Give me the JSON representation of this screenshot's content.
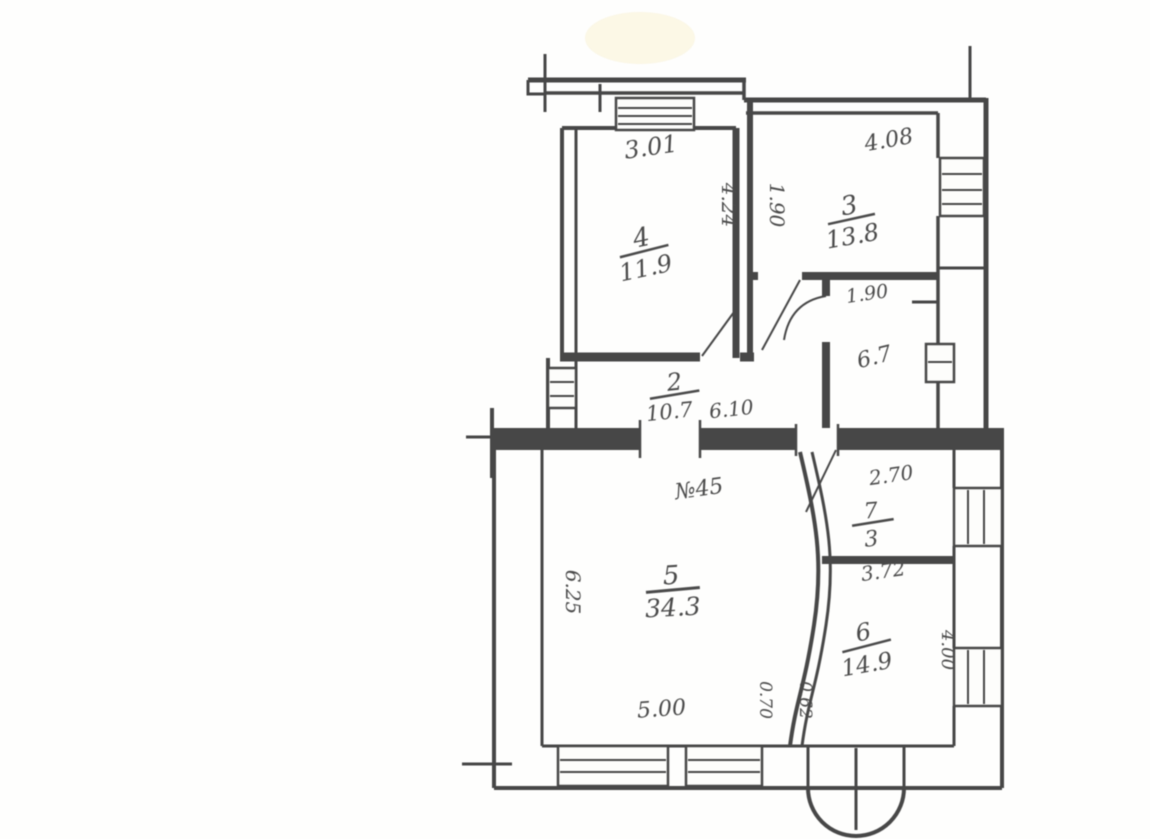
{
  "document": {
    "title": "apartment-floor-plan-scan",
    "apartment_number_label": "№45",
    "paper_color": "#fdfdfb",
    "ink_color": "#474747"
  },
  "rooms": [
    {
      "name": "room-4",
      "number": "4",
      "area": "11.9"
    },
    {
      "name": "room-3",
      "number": "3",
      "area": "13.8"
    },
    {
      "name": "bathroom",
      "number": "",
      "area": "6.7"
    },
    {
      "name": "hallway",
      "number": "2",
      "area": "10.7"
    },
    {
      "name": "room-7",
      "number": "7",
      "area": "3"
    },
    {
      "name": "room-5",
      "number": "5",
      "area": "34.3"
    },
    {
      "name": "room-6",
      "number": "6",
      "area": "14.9"
    }
  ],
  "dimensions": {
    "room4_width": "3.01",
    "room4_depth": "4.24",
    "room3_width": "4.08",
    "room3_left": "1.90",
    "bathroom_width": "1.90",
    "hallway_length": "6.10",
    "room7_width": "2.70",
    "room5_width": "5.00",
    "room5_depth": "6.25",
    "room6_width": "3.72",
    "room6_depth": "4.00",
    "door_left": "0.70",
    "door_right": "0.62"
  }
}
